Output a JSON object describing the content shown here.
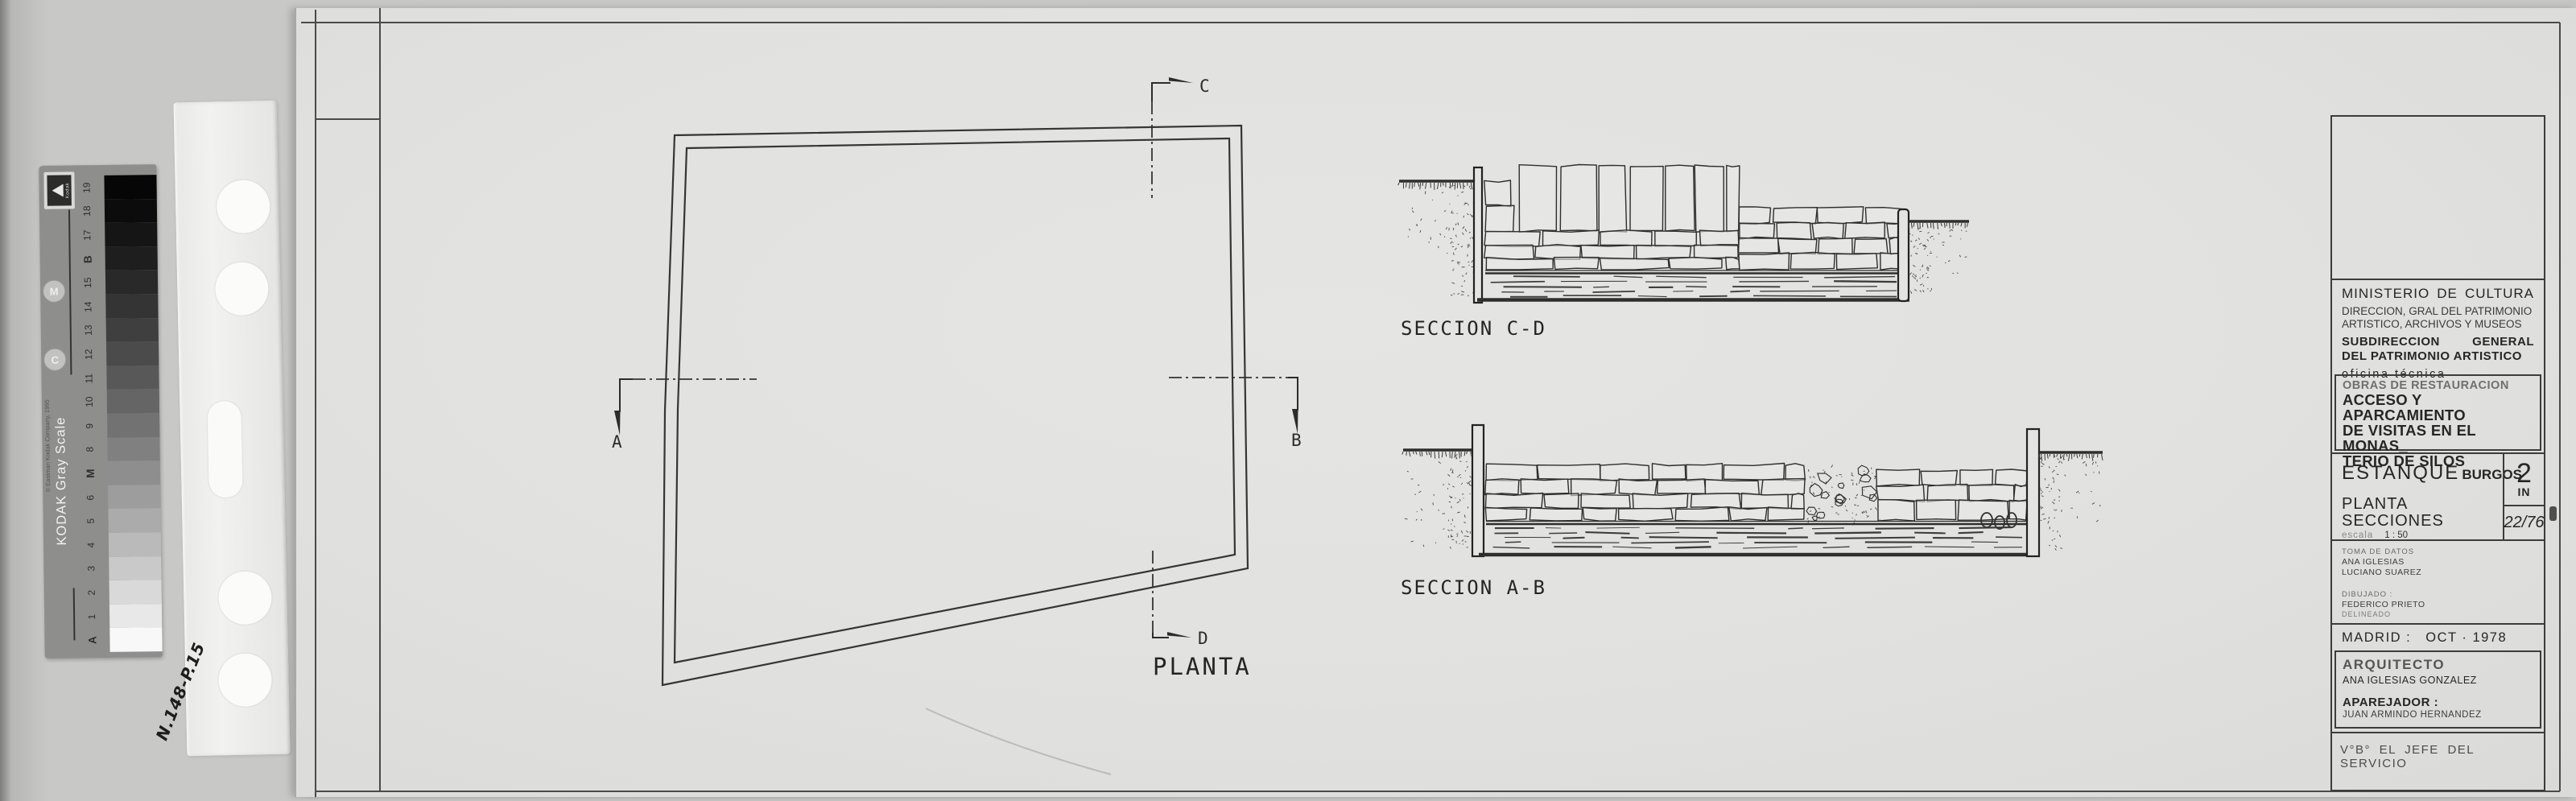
{
  "drawing": {
    "plan_label": "PLANTA",
    "section_cd_label": "SECCION C-D",
    "section_ab_label": "SECCION A-B",
    "marker_a": "A",
    "marker_b": "B",
    "marker_c": "C",
    "marker_d": "D"
  },
  "title_block": {
    "ministry_line1": "MINISTERIO DE CULTURA",
    "ministry_line2": "DIRECCION, GRAL DEL PATRIMONIO",
    "ministry_line3": "ARTISTICO, ARCHIVOS Y MUSEOS",
    "subdir_line1": "SUBDIRECCION GENERAL",
    "subdir_line2": "DEL PATRIMONIO ARTISTICO",
    "office": "oficina técnica",
    "works_type": "OBRAS DE RESTAURACION",
    "project_line1": "ACCESO Y APARCAMIENTO",
    "project_line2": "DE VISITAS EN EL MONAS_",
    "project_line3": "TERIO DE SILOS",
    "project_city": "BURGOS",
    "drawing_name": "ESTANQUE",
    "drawing_content1": "PLANTA",
    "drawing_content2": "SECCIONES",
    "scale_label": "escala",
    "scale_value": "1 : 50",
    "sheet_number": "2",
    "sheet_number_suffix": "IN",
    "archive_number": "22/76",
    "data_label": "TOMA DE DATOS",
    "data_name1": "ANA IGLESIAS",
    "data_name2": "LUCIANO SUAREZ",
    "drawn_label": "DIBUJADO :",
    "drawn_name": "FEDERICO PRIETO",
    "drawn_sub": "DELINEADO",
    "place_label": "MADRID :",
    "date_value": "OCT · 1978",
    "architect_label": "ARQUITECTO",
    "architect_name": "ANA IGLESIAS GONZALEZ",
    "surveyor_label": "APAREJADOR :",
    "surveyor_name": "JUAN ARMINDO HERNANDEZ",
    "approval": "V°B° EL JEFE DEL SERVICIO"
  },
  "kodak_scale": {
    "brand": "KODAK Gray Scale",
    "copyright": "© Eastman Kodak Company, 1995",
    "steps": [
      "A",
      "1",
      "2",
      "3",
      "4",
      "5",
      "6",
      "M",
      "8",
      "9",
      "10",
      "11",
      "12",
      "13",
      "14",
      "15",
      "B",
      "17",
      "18",
      "19"
    ],
    "circle_letters": [
      "M",
      "C"
    ]
  },
  "film_strip": {
    "handwritten_number": "N.148-P.15"
  },
  "colors": {
    "paper": "#e1e1df",
    "background": "#c8c8c6",
    "ink": "#2e2e2c",
    "card_gray": "#8e8e8c"
  }
}
